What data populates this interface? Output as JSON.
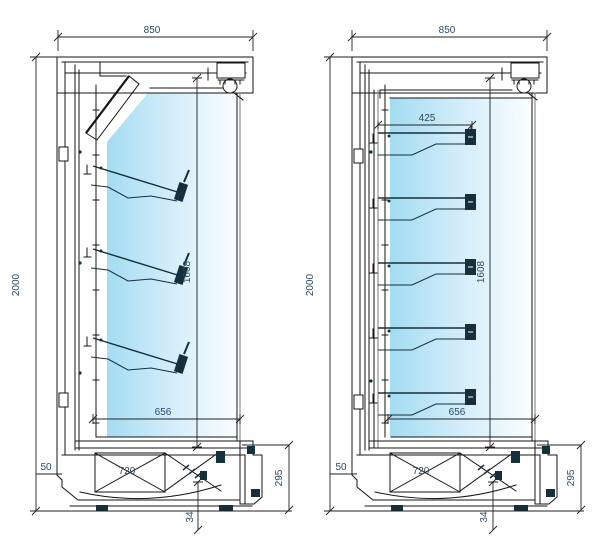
{
  "page": {
    "background": "#ffffff",
    "kind": "refrigerated-display-cabinet-cross-sections"
  },
  "colors": {
    "line": "#161616",
    "line_secondary": "#7a7a7a",
    "dimension_text": "#2b4a63",
    "shelf_dark": "#14303c",
    "glass_gradient_start": "#a3dcf2",
    "glass_gradient_mid": "#cfecf9",
    "glass_gradient_end": "#fbfeff"
  },
  "left_drawing": {
    "name": "section-with-inclined-shelves",
    "shelf_count": 3,
    "shelf_type": "inclined",
    "dimensions": {
      "overall_width": "850",
      "overall_height": "2000",
      "display_height": "1608",
      "display_depth": "656",
      "base_depth": "720",
      "plinth_offset": "50",
      "base_height": "295",
      "floor_clearance": "34"
    }
  },
  "right_drawing": {
    "name": "section-with-flat-shelves",
    "shelf_count": 5,
    "shelf_type": "horizontal",
    "dimensions": {
      "overall_width": "850",
      "overall_height": "2000",
      "shelf_depth": "425",
      "display_height": "1608",
      "display_depth": "656",
      "base_depth": "720",
      "plinth_offset": "50",
      "base_height": "295",
      "floor_clearance": "34"
    }
  }
}
